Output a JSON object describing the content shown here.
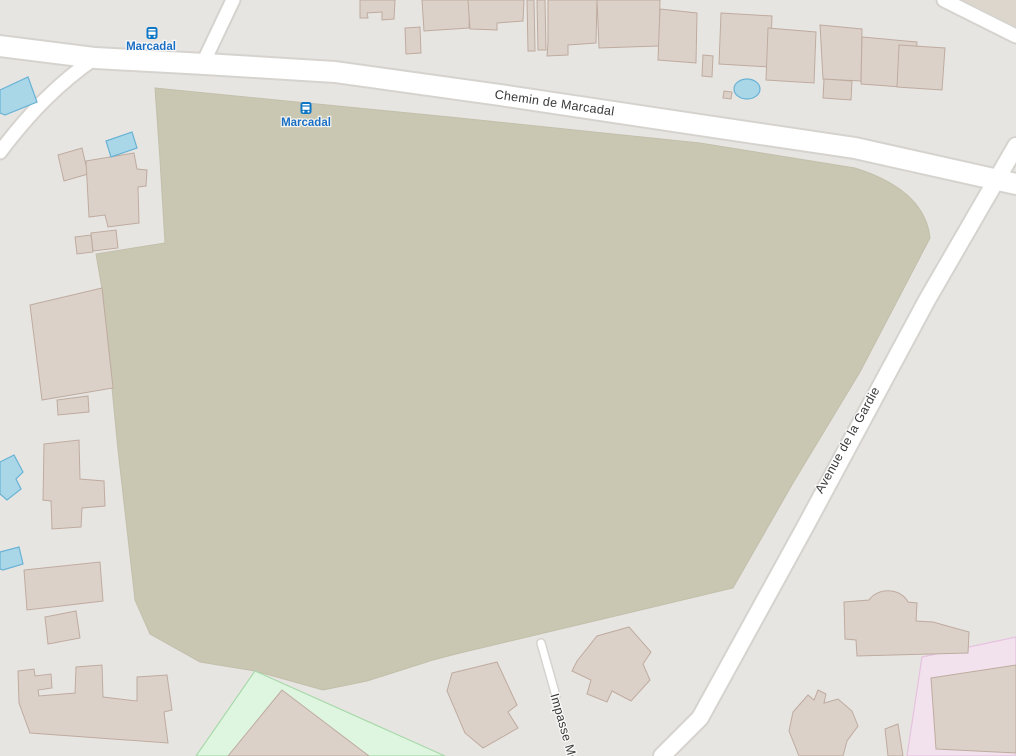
{
  "map": {
    "type": "openstreetmap-style street map",
    "labels": {
      "road_top": "Chemin de Marcadal",
      "road_right": "Avenue de la Gardie",
      "road_bottom": "Impasse Mé",
      "bus_stop_north": "Marcadal",
      "bus_stop_field": "Marcadal"
    },
    "icons": {
      "bus_stop": "bus-icon"
    },
    "colors": {
      "background": "#e7e5e2",
      "brownfield_area": "#c9c6b1",
      "building_fill": "#dbd1c9",
      "building_outline": "#bfab9f",
      "road": "#ffffff",
      "water": "#a9d7e8",
      "playground_fill": "#def6e0",
      "playground_border": "#a8d9aa",
      "pink_area": "#f2e2ee",
      "bus_blue": "#0d77c6",
      "bus_label_blue": "#1a6fc4",
      "road_label": "#383838"
    }
  }
}
